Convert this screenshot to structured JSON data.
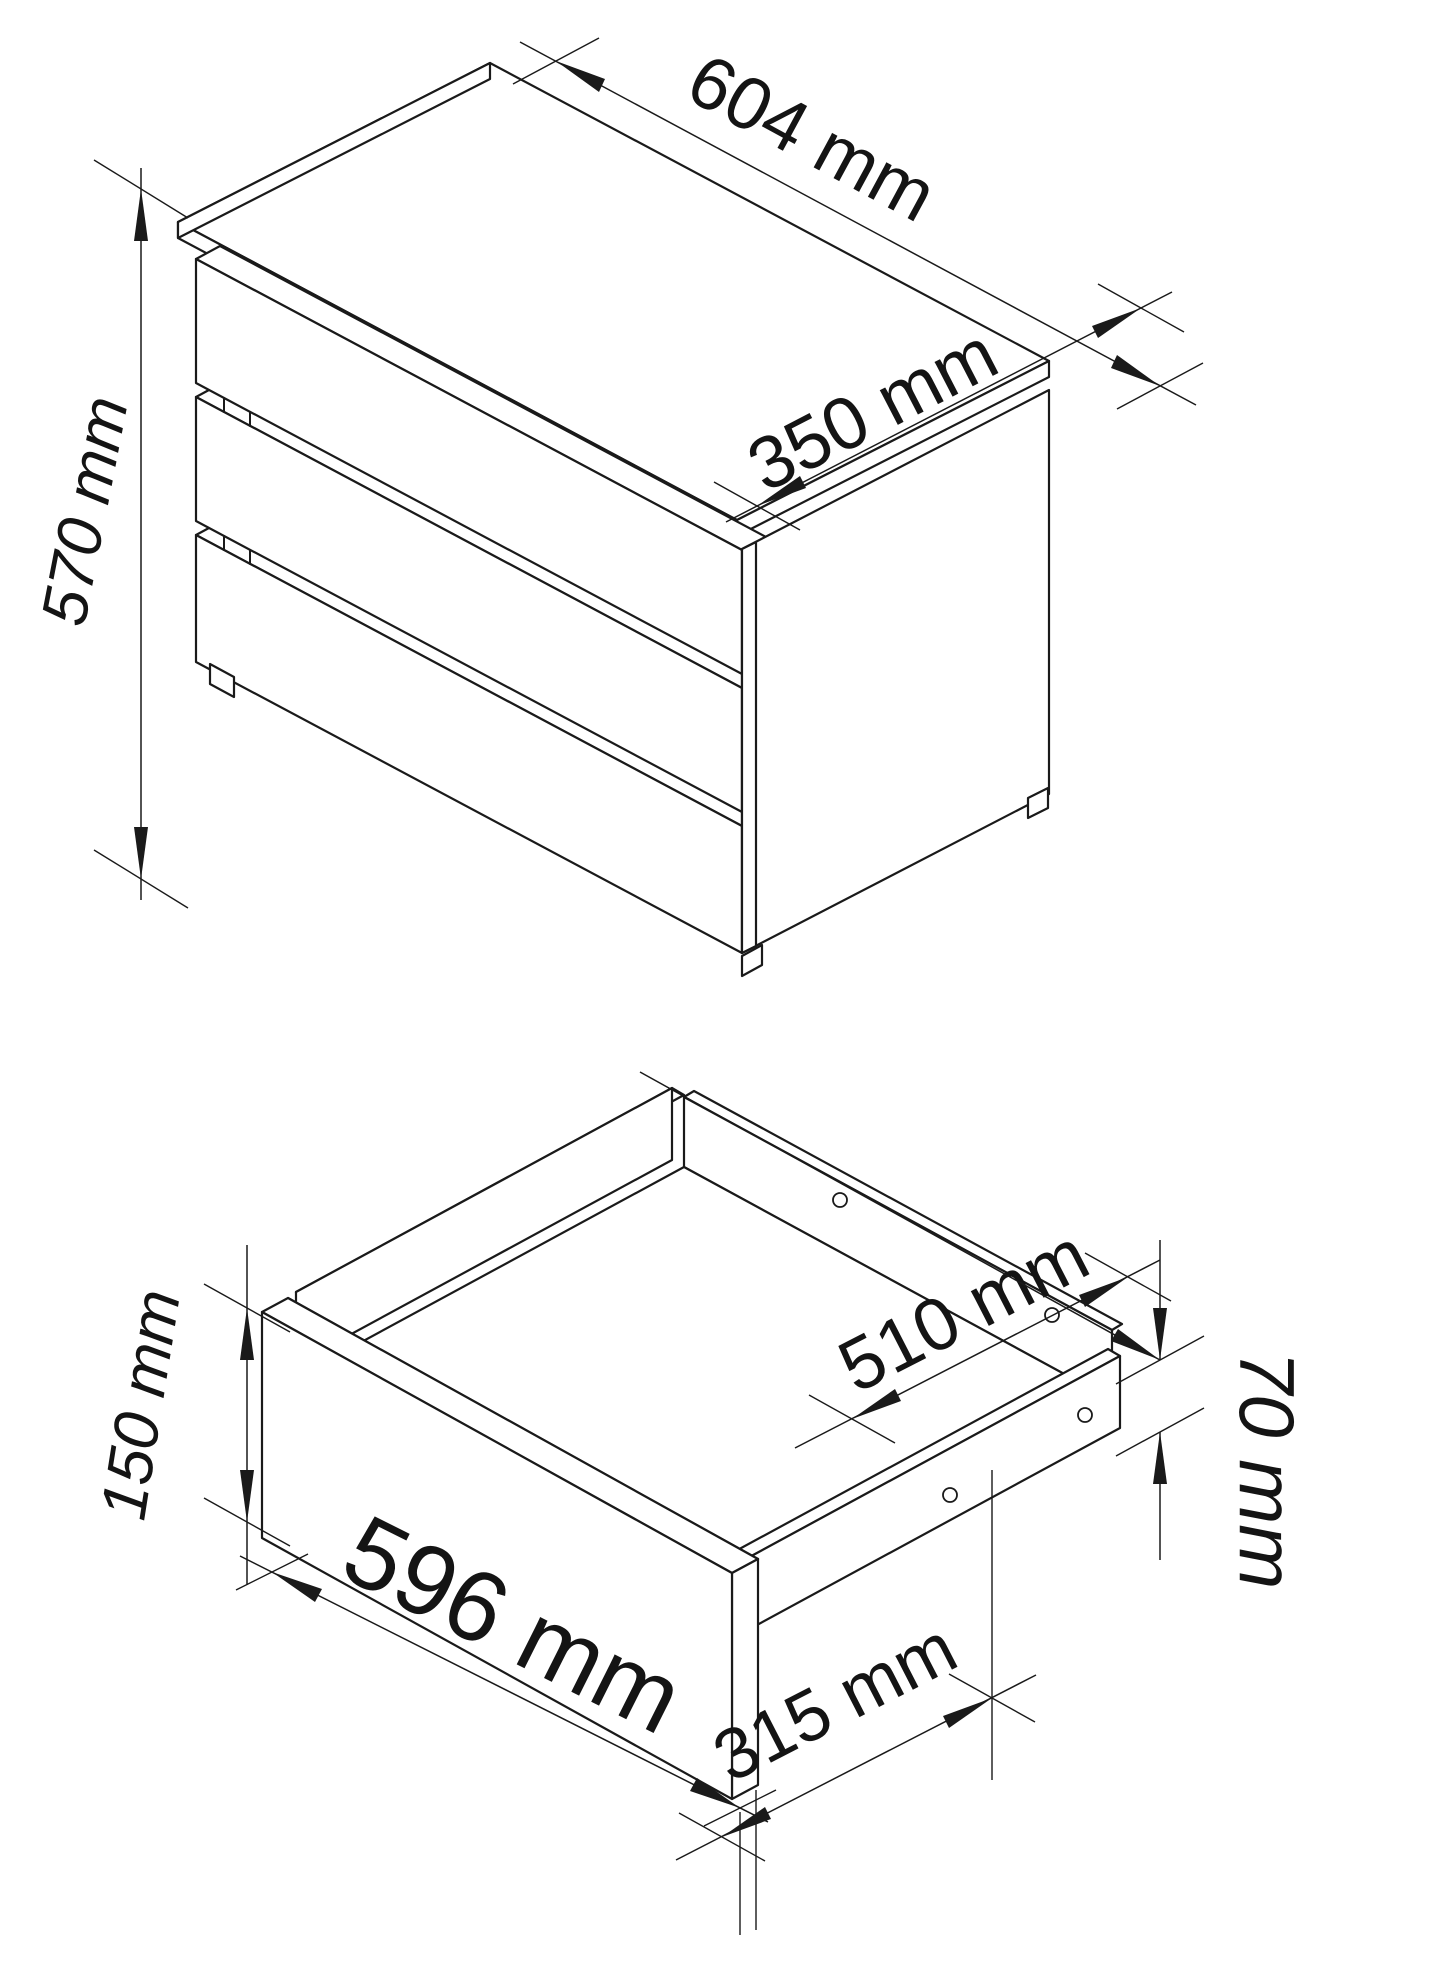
{
  "page": {
    "title": "Furniture dimension drawing",
    "background_color": "#ffffff",
    "line_color": "#1a1a1a",
    "unit": "mm"
  },
  "figures": {
    "chest": {
      "name": "3-drawer chest isometric view",
      "drawer_count": 3,
      "dimensions": {
        "width": "604 mm",
        "depth": "350 mm",
        "height": "570 mm"
      }
    },
    "drawer": {
      "name": "open drawer isometric view",
      "dimensions": {
        "front_width": "596 mm",
        "front_height": "150 mm",
        "inner_depth": "510 mm",
        "side_height": "70 mm",
        "bottom_depth": "315 mm"
      }
    }
  }
}
